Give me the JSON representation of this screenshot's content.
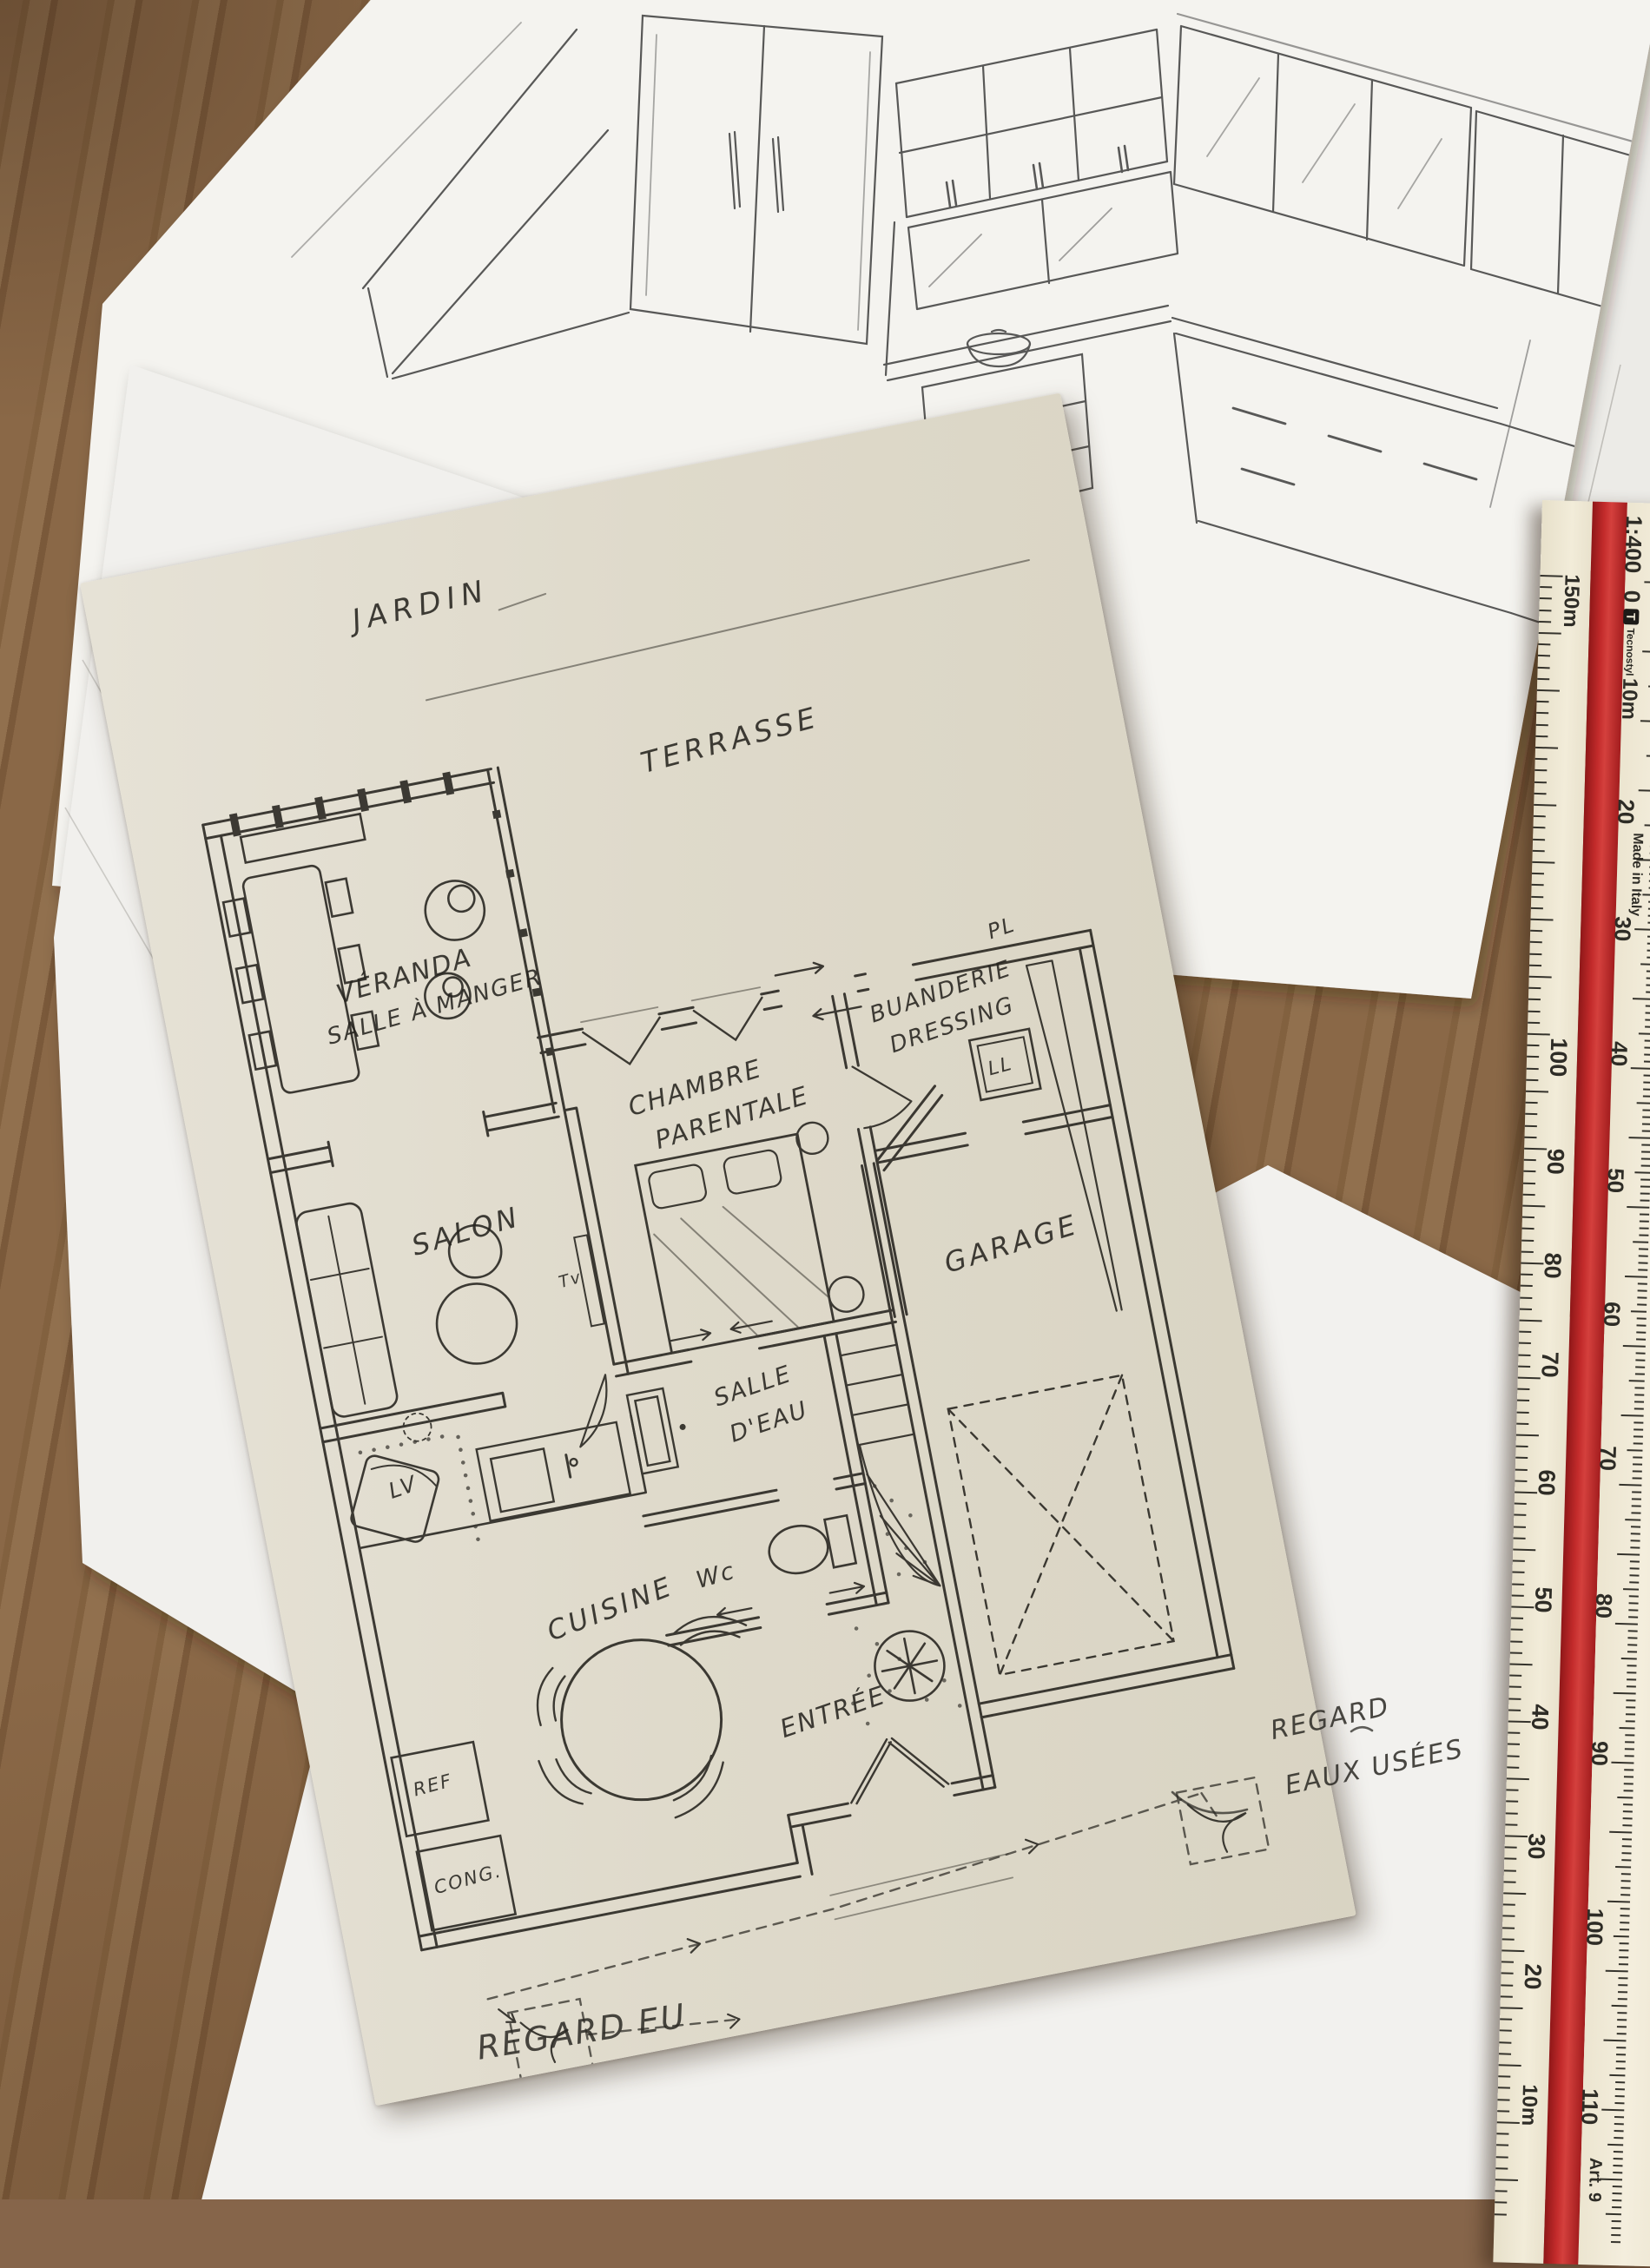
{
  "labels": {
    "jardin": "JARDIN",
    "terrasse": "TERRASSE",
    "veranda_line1": "VÉRANDA",
    "veranda_line2": "SALLE À MANGER",
    "chambre_line1": "CHAMBRE",
    "chambre_line2": "PARENTALE",
    "buanderie_line1": "BUANDERIE",
    "buanderie_line2": "DRESSING",
    "pl": "PL",
    "ll": "LL",
    "salon": "SALON",
    "tv": "Tv",
    "garage": "GARAGE",
    "salle_deau_line1": "SALLE",
    "salle_deau_line2": "D'EAU",
    "wc": "Wc",
    "lv": "LV",
    "cuisine": "CUISINE",
    "entree": "ENTRÉE",
    "ref": "REF",
    "cong": "CONG.",
    "regard_eu_line1": "REGARD",
    "regard_eu_line2": "EAUX USÉES",
    "regard_eu2": "REGARD EU"
  },
  "ruler": {
    "scale_label": "1:400",
    "brand": "Tecnostyl",
    "made_in": "Made in Italy",
    "art": "Art. 9",
    "left_top": "150m",
    "left": [
      "100",
      "90",
      "80",
      "70",
      "60",
      "50",
      "40",
      "30",
      "20",
      "10m"
    ],
    "right": [
      "0",
      "10m",
      "20",
      "30",
      "40",
      "50",
      "60",
      "70",
      "80",
      "90",
      "100",
      "110"
    ],
    "red_color": "#c32b2b",
    "body_color": "#efe9d6"
  }
}
